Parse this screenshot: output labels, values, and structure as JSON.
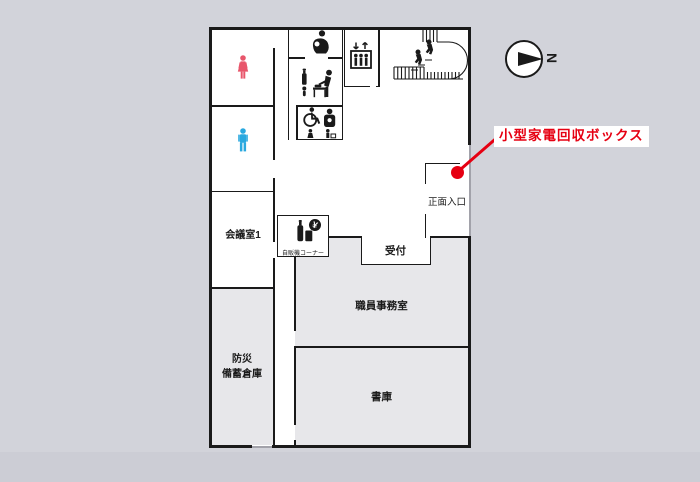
{
  "annotation": {
    "label": "小型家電回収ボックス"
  },
  "compass": {
    "label": "N"
  },
  "rooms": {
    "meeting": {
      "label": "会議室1"
    },
    "disaster": {
      "line1": "防災",
      "line2": "備蓄倉庫"
    },
    "staff_office": {
      "label": "職員事務室"
    },
    "archive": {
      "label": "書庫"
    },
    "reception": {
      "label": "受付"
    },
    "entrance": {
      "label": "正面入口"
    },
    "vending": {
      "label": "自販機コーナー"
    }
  },
  "colors": {
    "background": "#d2d3da",
    "wall": "#1a1a1a",
    "room_fill": "#e7e7ea",
    "red": "#e60012",
    "female_icon": "#e8566b",
    "male_icon": "#29a8df"
  },
  "icons": {
    "female": "female-toilet-icon",
    "male": "male-toilet-icon",
    "nursing": "nursing-room-icon",
    "baby_care": "baby-changing-icon",
    "accessible": "accessible-toilet-icon",
    "elevator": "elevator-icon",
    "stairs": "stairs-icon",
    "vending": "vending-machine-icon",
    "marker": "location-dot-icon",
    "compass": "north-arrow-icon"
  }
}
